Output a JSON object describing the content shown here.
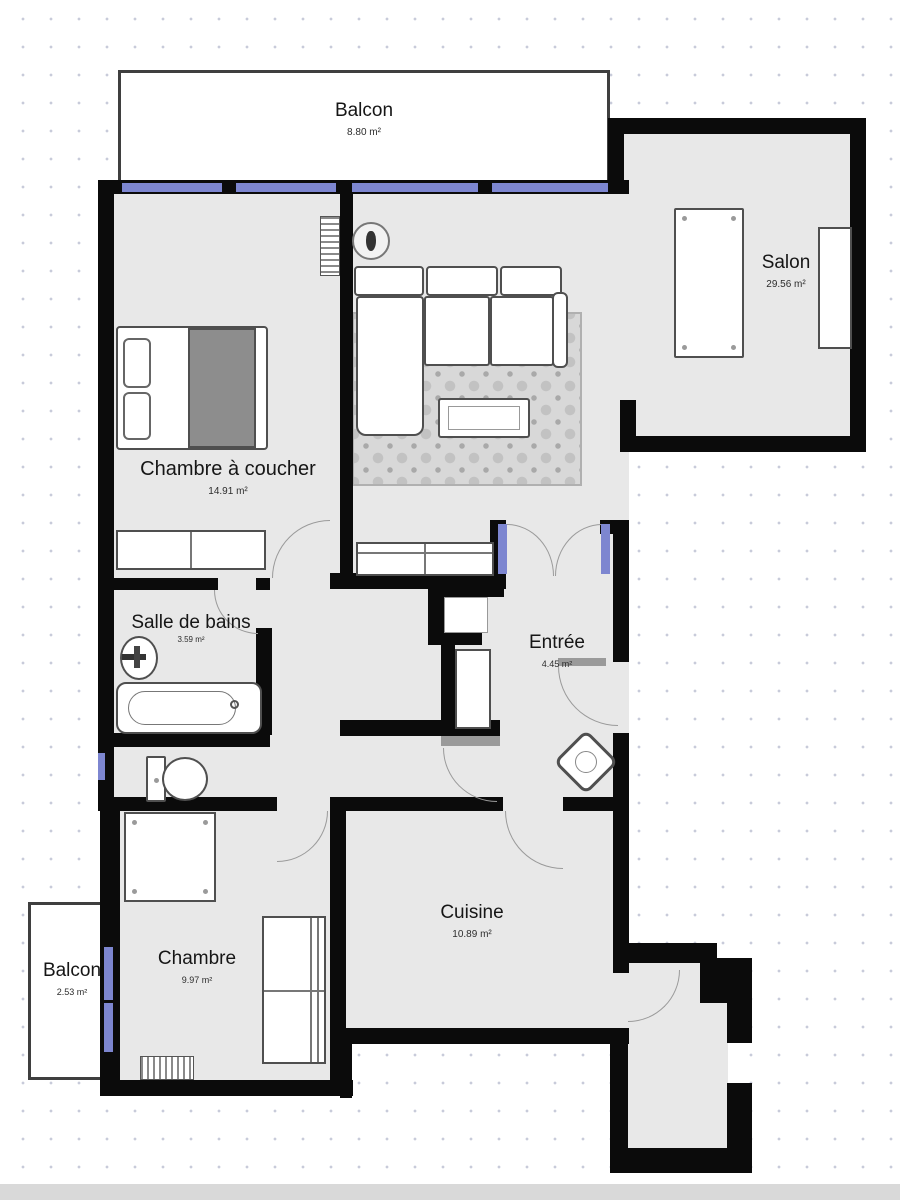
{
  "plan": {
    "rooms": [
      {
        "name": "Balcon",
        "area": "8.80 m²"
      },
      {
        "name": "Salon",
        "area": "29.56 m²"
      },
      {
        "name": "Chambre à coucher",
        "area": "14.91 m²"
      },
      {
        "name": "Salle de bains",
        "area": "3.59 m²"
      },
      {
        "name": "Entrée",
        "area": "4.45 m²"
      },
      {
        "name": "Chambre",
        "area": "9.97 m²"
      },
      {
        "name": "Cuisine",
        "area": "10.89 m²"
      },
      {
        "name": "Balcon",
        "area": "2.53 m²"
      }
    ],
    "colors": {
      "wall": "#0b0b0b",
      "floor": "#e8e8e8",
      "window": "#7d86d0",
      "arc": "#9a9a9a",
      "furniture_outline": "#4f4f4f",
      "rug": "#d8d8d8",
      "blanket": "#8d8d8d",
      "label_text": "#161616",
      "bottom_bar": "#d9d9d9"
    }
  }
}
